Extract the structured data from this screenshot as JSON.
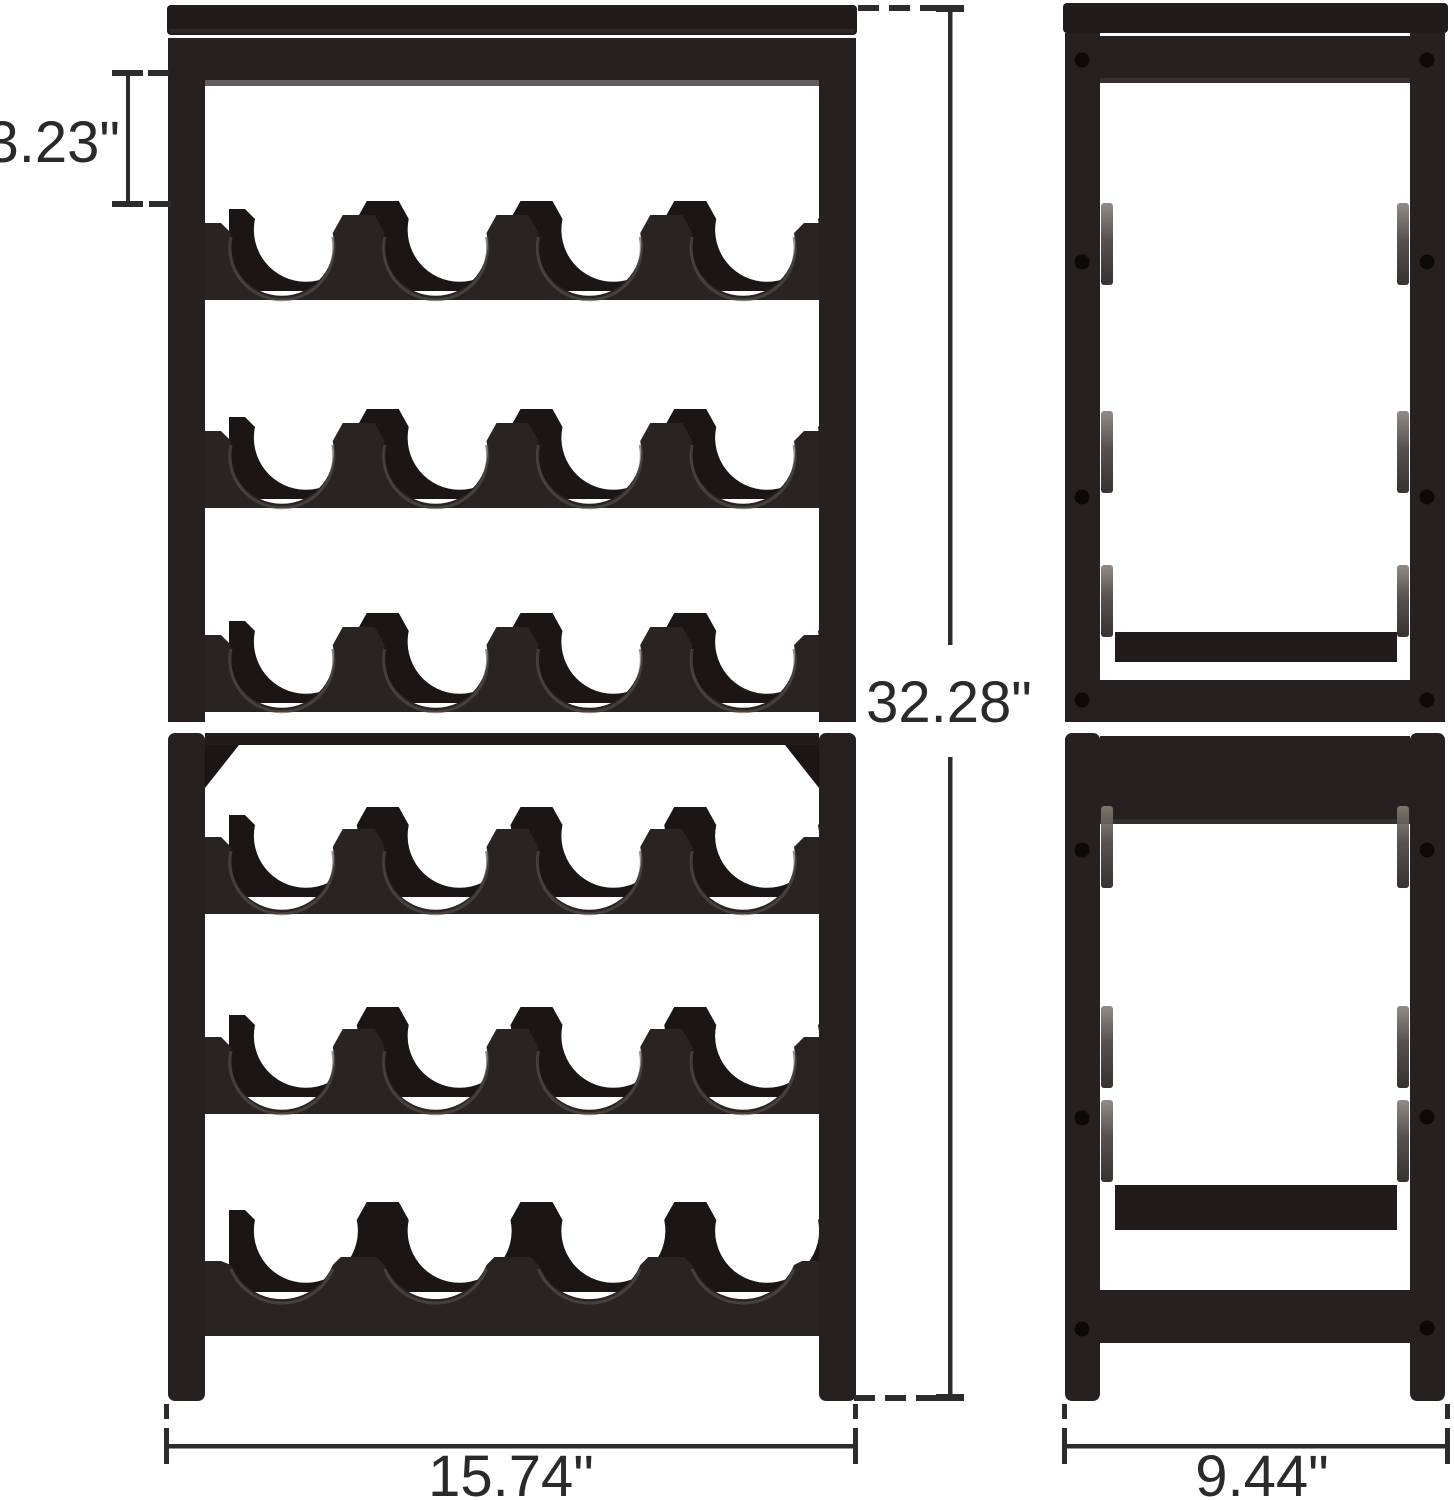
{
  "page": {
    "background": "#ffffff",
    "description": "Product dimension diagram of a 6-tier stackable wine rack, front view and side view"
  },
  "diagram": {
    "views": [
      {
        "id": "front",
        "name": "front-view"
      },
      {
        "id": "side",
        "name": "side-view"
      }
    ],
    "product": {
      "rows": 6,
      "bottle_slots_per_row": 4,
      "stacked_units": 2
    },
    "dimensions": {
      "shelf_opening_height": {
        "label": "3.23\""
      },
      "overall_height": {
        "label": "32.28\""
      },
      "overall_width": {
        "label": "15.74\""
      },
      "overall_depth": {
        "label": "9.44\""
      }
    },
    "colors": {
      "background": "#ffffff",
      "rack_body": "#292322",
      "rack_dark": "#1b1615",
      "rack_panel": "#211c1b",
      "rack_leg": "#262020",
      "rack_edge_light": "#3b3533",
      "rack_highlight": "#57514d",
      "screw": "#0c0a09",
      "dim_line": "#2d2b2b",
      "dim_text": "#2b2929"
    }
  }
}
